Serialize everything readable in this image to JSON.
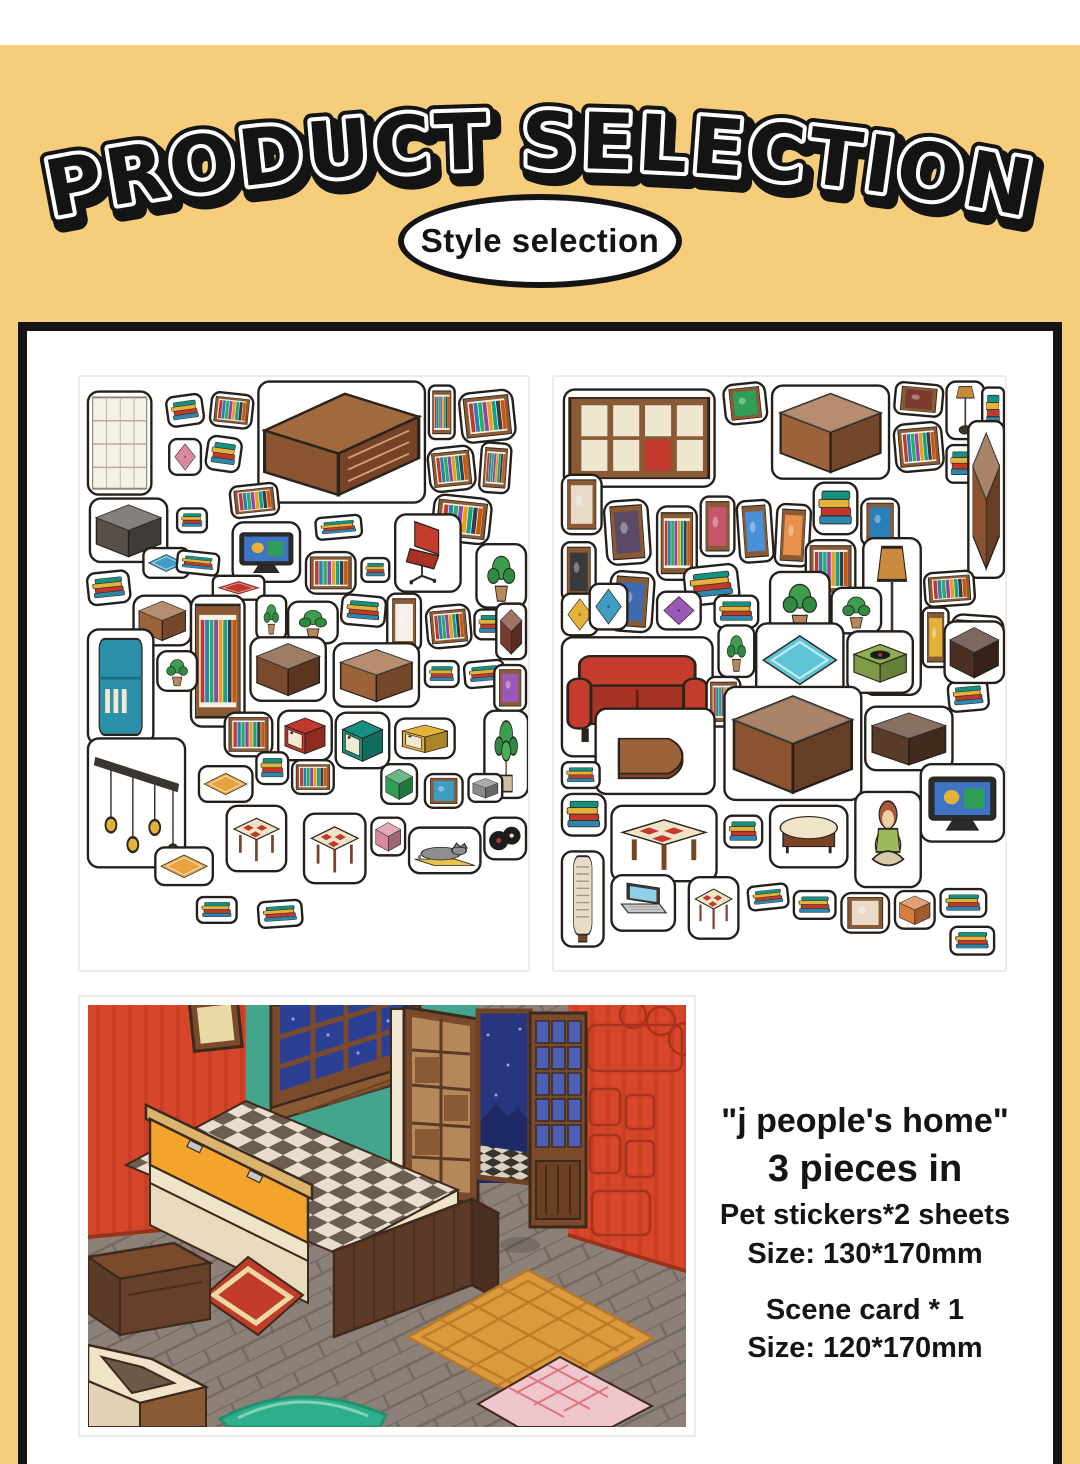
{
  "page": {
    "background_color": "#F5CD7B",
    "top_strip_color": "#FFFFFF",
    "panel_border_color": "#141414",
    "accent_red": "#D5462B",
    "accent_teal": "#43A68C"
  },
  "header": {
    "title": "PRODUCT SELECTION",
    "badge_label": "Style selection"
  },
  "gallery": {
    "sheet1_alt": "Sticker sheet 1: study furniture stickers - desk, bookshelves, TV, red chair, fridge, plants, stools",
    "sheet2_alt": "Sticker sheet 2: living room furniture stickers - red sofa, cabinets, floor lamp, record player, TV, girl",
    "scene_alt": "Scene card: isometric room with red striped walls, teal wall, window, door, checkered bed platform and rugs"
  },
  "specs": {
    "name_line": "\"j people's home\"",
    "pieces_line": "3 pieces in",
    "sticker_count_line": "Pet stickers*2 sheets",
    "sticker_size_line": "Size: 130*170mm",
    "scene_count_line": "Scene card * 1",
    "scene_size_line": "Size: 120*170mm"
  }
}
